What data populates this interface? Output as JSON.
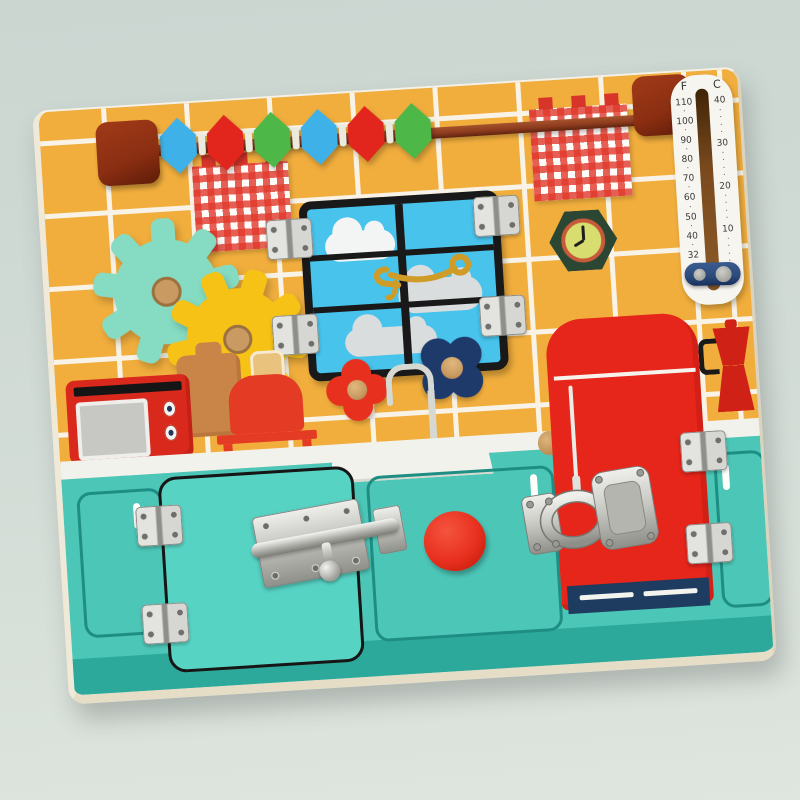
{
  "scene": {
    "description": "wooden kitchen busy board toy photographed on pale sage background"
  },
  "colors": {
    "bg-top": "#cbd6d1",
    "bg-mid": "#d3dcd6",
    "bg-bot": "#dfe5df",
    "board-edge": "#f0e9d8",
    "board-edge-dk": "#e6ddc6",
    "tile": "#f1ae3d",
    "grout": "#f8f3e6",
    "teal": "#4cc6b7",
    "teal-door": "#57d3c4",
    "teal-dark": "#2da99b",
    "teal-line": "#1e8e84",
    "counter": "#f1f2ec",
    "faucet": "#d6d8d2",
    "fridge-red": "#e6251b",
    "fridge-navy": "#1e3b60",
    "window-sky": "#47c3ec",
    "window-frame": "#191919",
    "cloud-white": "#f3f4f4",
    "cloud-gray": "#d9dddd",
    "gold": "#cf9c28",
    "mint-gear": "#85dcc3",
    "yellow-gear": "#f6c215",
    "wood-peg": "#c99a62",
    "rod-brown": "#8e3c1e",
    "cap-brown": "#8a2e12",
    "gingham-red": "#d7342a",
    "clock-frame": "#2b4733",
    "clock-ring": "#c75a39",
    "clock-face": "#d7de6f",
    "red-accent": "#e8301f",
    "navy-knob": "#1e3a6b",
    "knob-red": "#e8301f",
    "microwave-red": "#d9291c",
    "toaster-red": "#e43b24",
    "toast-tan": "#e9c27d",
    "board-tan": "#c98548",
    "moka-red": "#cf2115",
    "thermo-plate": "#f7f5f0",
    "thermo-slider": "#2c4a7c"
  },
  "abacus": {
    "bead_colors": [
      "#3eb2e8",
      "#e3261d",
      "#4db748",
      "#3eb2e8",
      "#e3261d",
      "#4db748"
    ]
  },
  "thermometer": {
    "f_label": "F",
    "c_label": "C",
    "f_scale": [
      "110",
      "100",
      "90",
      "80",
      "70",
      "60",
      "50",
      "40",
      "32",
      "20"
    ],
    "c_scale": [
      "40",
      "30",
      "20",
      "10",
      "0"
    ]
  }
}
